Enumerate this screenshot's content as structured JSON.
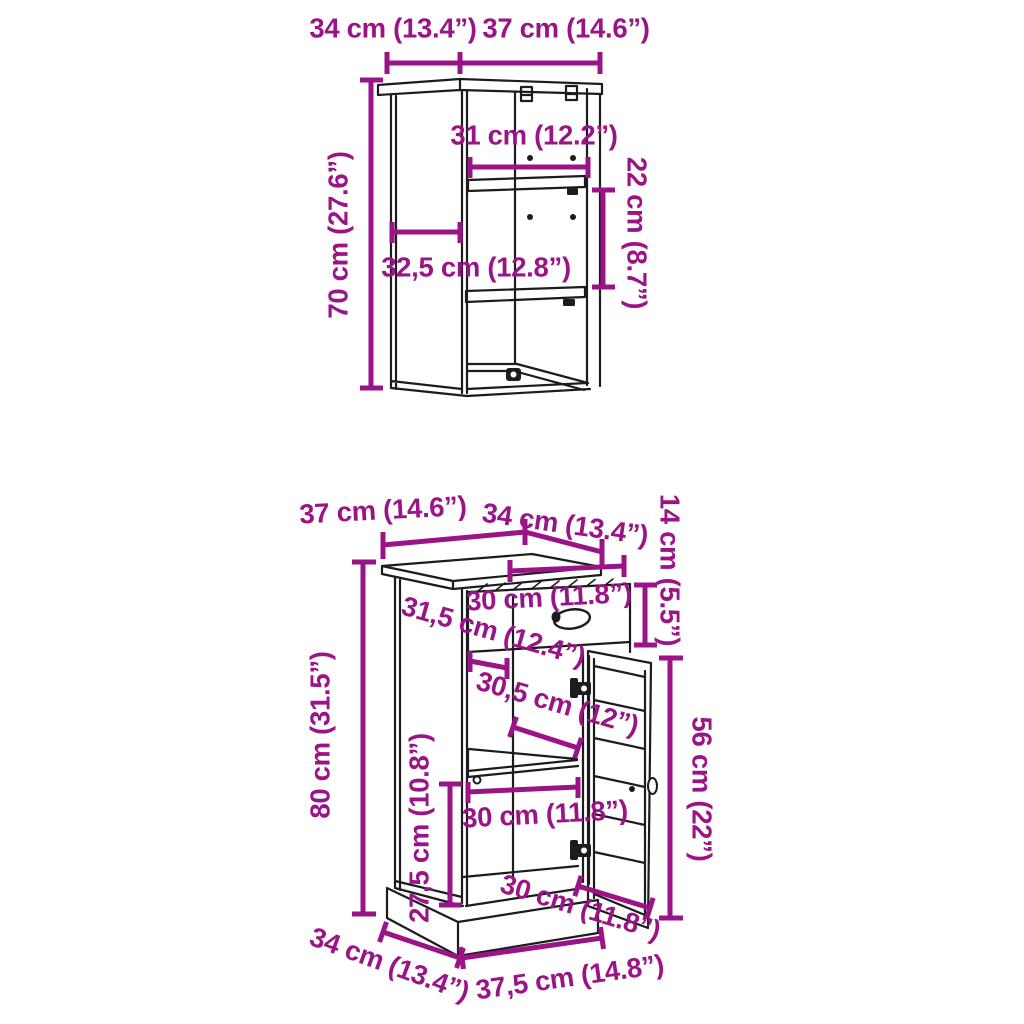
{
  "colors": {
    "dimension": "#9a1487",
    "line_art": "#1c1c1c",
    "background": "#ffffff"
  },
  "wall_cabinet": {
    "labels": {
      "top_depth": "34 cm (13.4”)",
      "top_width": "37 cm (14.6”)",
      "inner_width": "31 cm (12.2”)",
      "shelf_gap": "22 cm (8.7”)",
      "inner_depth": "32,5 cm (12.8”)",
      "height": "70 cm (27.6”)"
    }
  },
  "floor_cabinet": {
    "labels": {
      "top_width": "37 cm (14.6”)",
      "top_depth": "34 cm (13.4”)",
      "top_section_height": "14 cm (5.5”)",
      "drawer_width": "30 cm (11.8”)",
      "inner_depth": "31,5 cm (12.4”)",
      "inner_width_upper": "30,5 cm (12”)",
      "height": "80 cm (31.5”)",
      "door_height": "56 cm (22”)",
      "lower_section_height": "27,5 cm (10.8”)",
      "inner_width_lower": "30 cm (11.8”)",
      "door_width": "30 cm (11.8”)",
      "base_depth": "34 cm (13.4”)",
      "base_width": "37,5 cm (14.8”)"
    }
  }
}
